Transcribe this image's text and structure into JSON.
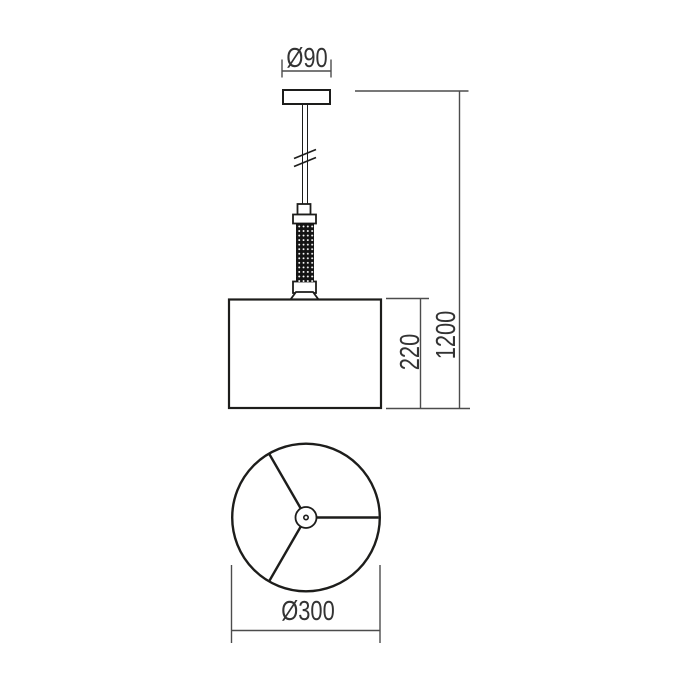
{
  "drawing": {
    "kind": "dimension-diagram",
    "views": {
      "side": {
        "canopy_diameter_label": "Ø90",
        "shade_height_label": "220",
        "overall_height_label": "1200"
      },
      "bottom": {
        "shade_diameter_label": "Ø300"
      }
    },
    "colors": {
      "background": "#ffffff",
      "object_line": "#1d1d1b",
      "dimension_line": "#4c4c4c",
      "text": "#333333"
    }
  }
}
